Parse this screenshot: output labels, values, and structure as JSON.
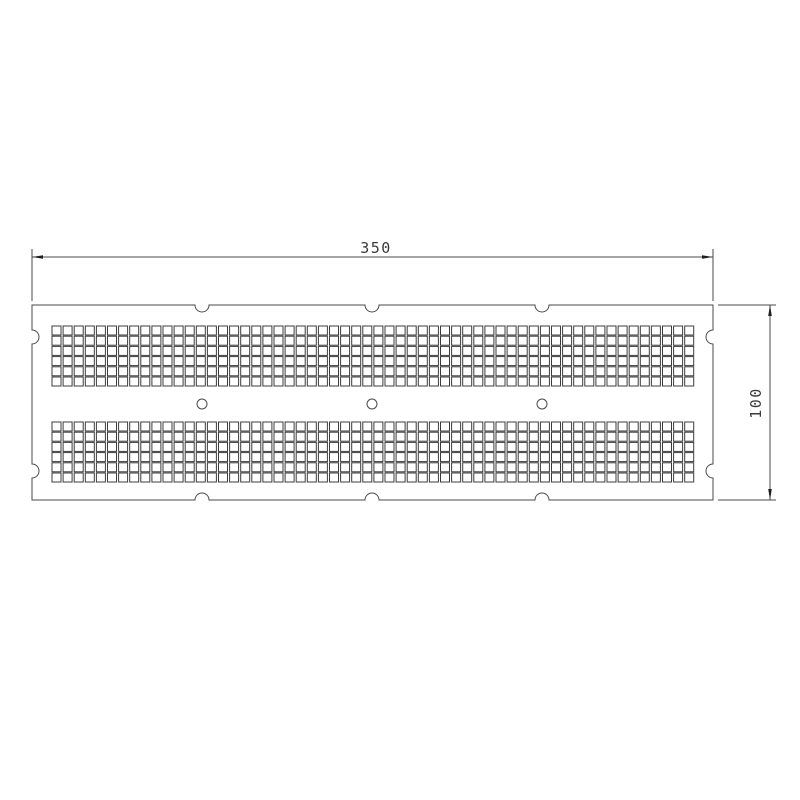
{
  "drawing": {
    "type": "technical-drawing",
    "subject": "perforated rectangular plate, top view",
    "dimension_labels": {
      "width": "350",
      "height": "100"
    },
    "canvas": {
      "width": 800,
      "height": 800,
      "background": "#ffffff"
    },
    "colors": {
      "line": "#4a4a4a",
      "grid_line": "#3c3c3c",
      "arrow": "#1f1f1f",
      "text": "#3a3a3a",
      "fill": "#ffffff"
    },
    "plate_px": {
      "left": 32,
      "top": 305,
      "right": 713,
      "bottom": 500
    },
    "edge_notches": {
      "radius": 7,
      "top_x": [
        202,
        372,
        542
      ],
      "bottom_x": [
        202,
        372,
        542
      ],
      "left_y": [
        337,
        471
      ],
      "right_y": [
        337,
        471
      ]
    },
    "square_grid": {
      "columns": 58,
      "rows_per_band": 6,
      "bands": 2,
      "square_size": 9,
      "pitch_x": 11.1,
      "pitch_y": 10.2,
      "start_x": 52,
      "band_tops_y": [
        326,
        422
      ]
    },
    "round_holes": {
      "cx": [
        202,
        372,
        542
      ],
      "cy": 404,
      "radius": 5
    },
    "dim_top": {
      "label": "350",
      "line_y": 257,
      "x1": 32,
      "x2": 713,
      "ext_y_top": 249,
      "ext_y_bottom": 301,
      "text_x": 376,
      "text_y": 253
    },
    "dim_right": {
      "label": "100",
      "line_x": 770,
      "y1": 305,
      "y2": 500,
      "ext_x_start": 718,
      "ext_x_end": 776,
      "text_x": 761,
      "text_y": 403
    }
  }
}
